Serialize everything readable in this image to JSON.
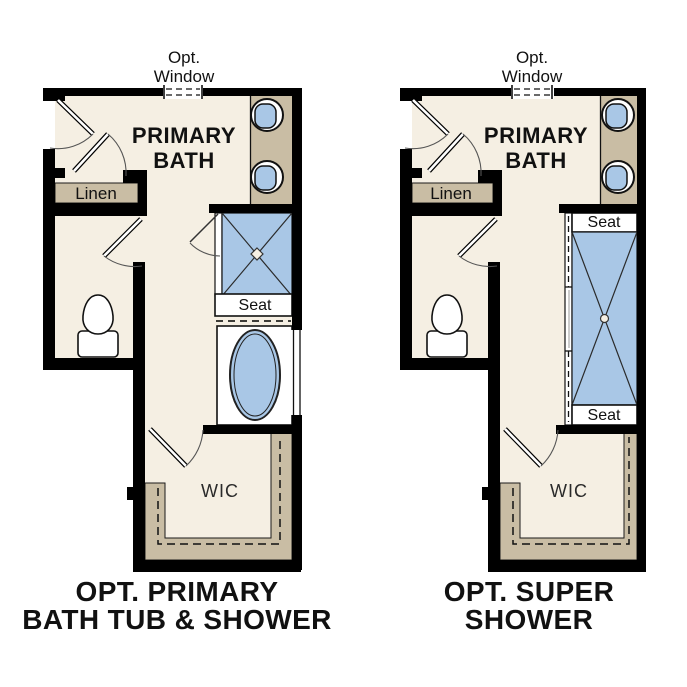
{
  "colors": {
    "wall": "#000000",
    "floor": "#f5efe3",
    "cabinet": "#c9bda4",
    "fixture": "#a9c7e6",
    "text": "#111111"
  },
  "plans": [
    {
      "window": [
        "Opt.",
        "Window"
      ],
      "room": [
        "PRIMARY",
        "BATH"
      ],
      "linen": "Linen",
      "seat": "Seat",
      "wic": "WIC",
      "caption": [
        "OPT. PRIMARY",
        "BATH TUB & SHOWER"
      ]
    },
    {
      "window": [
        "Opt.",
        "Window"
      ],
      "room": [
        "PRIMARY",
        "BATH"
      ],
      "linen": "Linen",
      "seat_top": "Seat",
      "seat_bottom": "Seat",
      "wic": "WIC",
      "caption": [
        "OPT. SUPER",
        "SHOWER"
      ]
    }
  ]
}
